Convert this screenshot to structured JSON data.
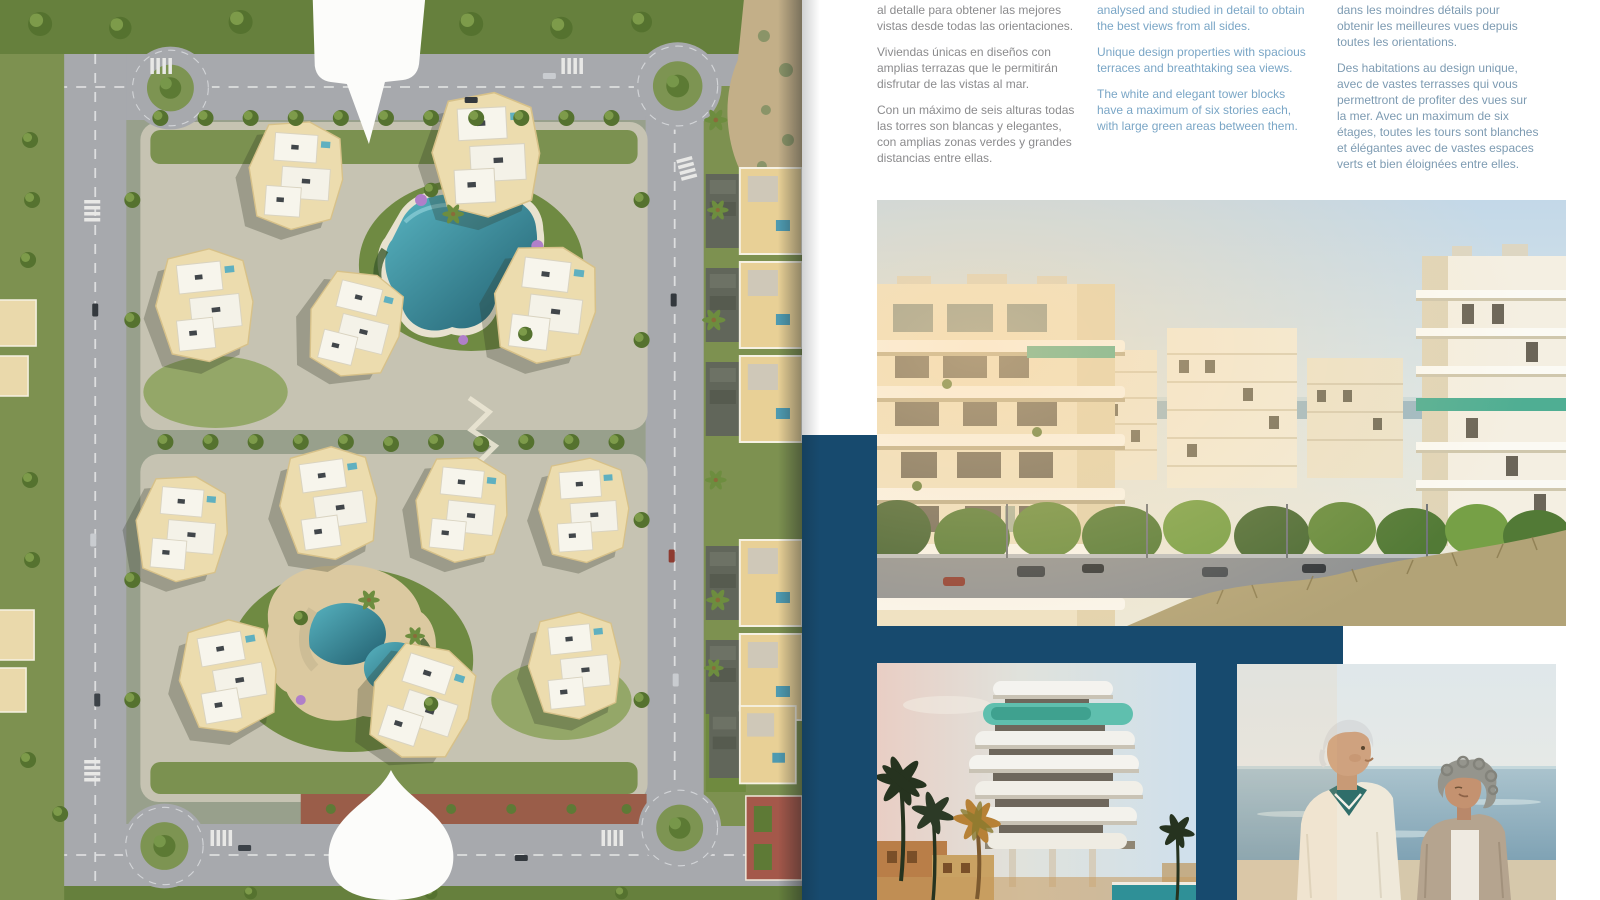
{
  "document": {
    "type": "property-brochure-spread",
    "languages": [
      "es",
      "en",
      "fr"
    ]
  },
  "colors": {
    "navy": "#174a6e",
    "page": "#ffffff",
    "text_es": "#8b8b8d",
    "text_en": "#7aa6c6",
    "text_fr": "#7d9bb2"
  },
  "columns": {
    "es": {
      "lang": "es",
      "paragraphs": [
        "al detalle para obtener las mejores\nvistas desde todas las orientaciones.",
        "Viviendas únicas en diseños con\namplias terrazas que le permitirán\ndisfrutar de las vistas al mar.",
        "Con un máximo de seis alturas todas\nlas torres son blancas y elegantes,\ncon amplias zonas verdes y grandes\ndistancias entre ellas."
      ]
    },
    "en": {
      "lang": "en",
      "paragraphs": [
        "analysed and studied in detail to obtain\nthe best views from all sides.",
        "Unique design properties with spacious\nterraces and breathtaking sea views.",
        "The white and elegant tower blocks\nhave a maximum of six stories each,\nwith large green areas between them."
      ]
    },
    "fr": {
      "lang": "fr",
      "paragraphs": [
        "dans les moindres détails pour\nobtenir les meilleures vues depuis\ntoutes les orientations.",
        "Des habitations au design unique,\navec de vastes terrasses qui vous\npermettront de profiter des vues sur\nla mer. Avec un maximum de six\nétages, toutes les tours sont blanches\net élégantes avec de vastes espaces\nverts et bien éloignées entre elles."
      ]
    }
  },
  "media": {
    "map": "masterplan-aerial-map",
    "photo_main": "residential-towers-street-photo",
    "photo_tower": "tower-closeup-dusk-photo",
    "photo_couple": "senior-couple-beach-photo"
  }
}
